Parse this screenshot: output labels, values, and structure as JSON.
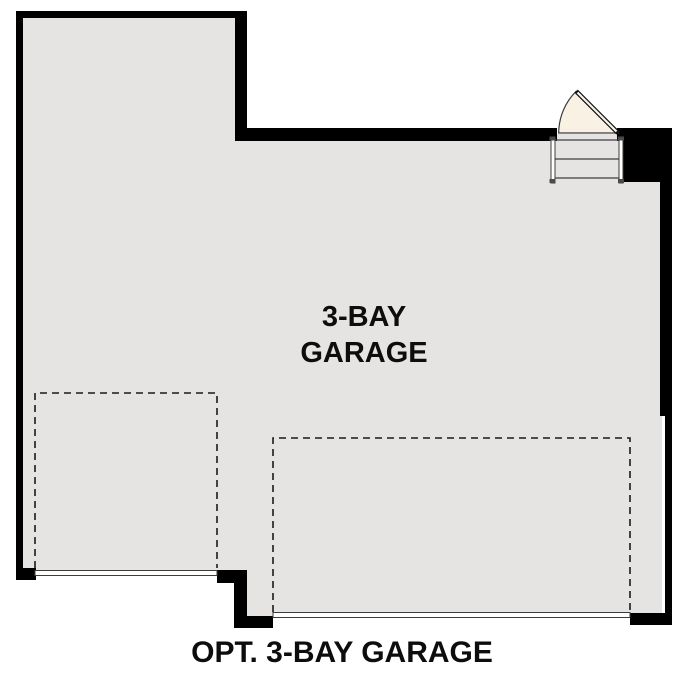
{
  "plan": {
    "room_label_line1": "3-BAY",
    "room_label_line2": "GARAGE",
    "caption": "OPT. 3-BAY GARAGE"
  },
  "colors": {
    "background": "#ffffff",
    "wall": "#000000",
    "floor": "#e5e4e2",
    "door": "#f8f1e4",
    "line": "#3d3d3d",
    "text": "#0d0d0d"
  }
}
